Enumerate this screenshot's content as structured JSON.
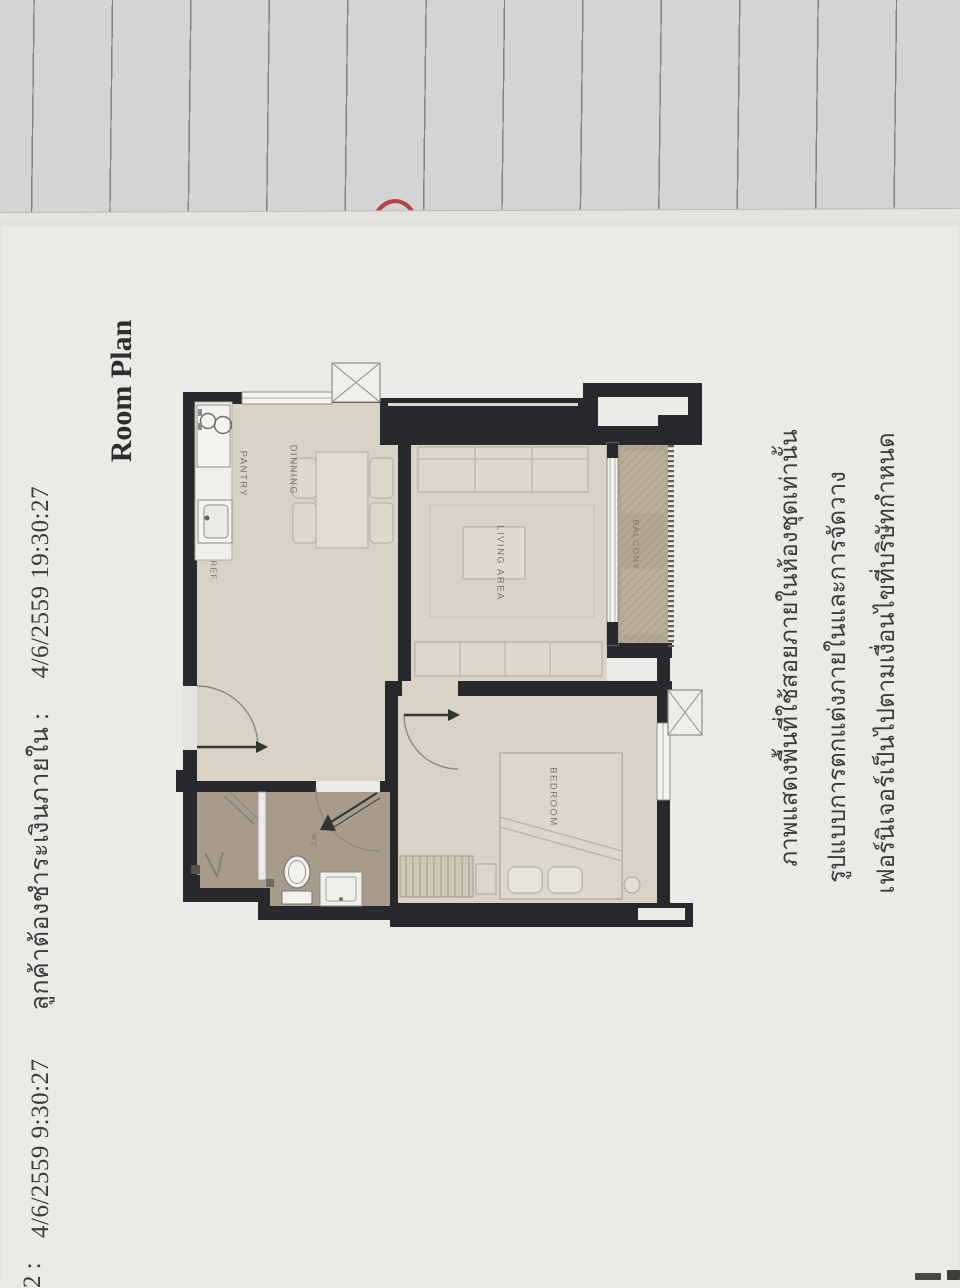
{
  "document": {
    "printed_at": "4/6/2559  9:30:27",
    "payment_notice": "ลูกค้าต้องชำระเงินภายใน :",
    "payment_deadline": "4/6/2559  19:30:27",
    "title": "Room Plan",
    "disclaimer": [
      "ภาพแสดงพื้นที่ใช้สอยภายในห้องชุดเท่านั้น",
      "รูปแบบการตกแต่งภายในและการจัดวาง",
      "เฟอร์นิเจอร์เป็นไปตามเงื่อนไขที่บริษัทกำหนด"
    ],
    "bottom_fragment": "2 :"
  },
  "floor_plan": {
    "labels": {
      "pantry": "PANTRY",
      "dining": "DINNING",
      "ref": "REF.",
      "living": "LIVING AREA",
      "balcony": "BALCONY",
      "bedroom": "BEDROOM",
      "wc": "WC"
    }
  },
  "colors": {
    "wall": "#28292c",
    "room_floor": "#d8d3c5",
    "balcony_floor": "#b4a895",
    "bathroom_floor": "#a79b8c",
    "page": "#ebeae6",
    "ruled_paper": "#d5d4d2",
    "pen_mark_red": "#b2434a"
  }
}
